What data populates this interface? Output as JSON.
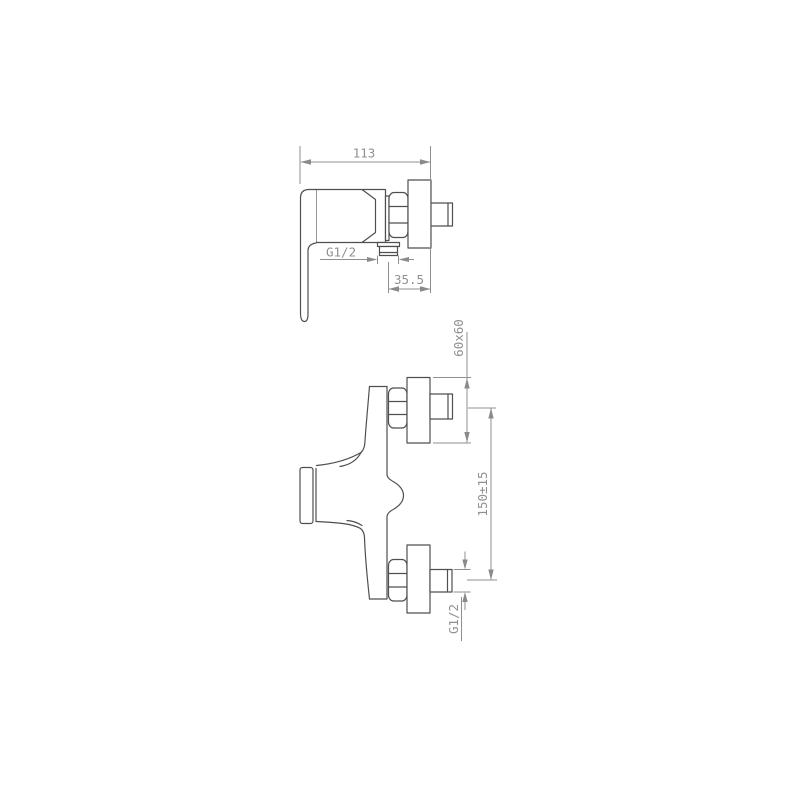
{
  "drawing": {
    "colors": {
      "background": "#ffffff",
      "object_line": "#4f4f4f",
      "dimension_line": "#8f8f8f",
      "text": "#909090"
    },
    "top_view": {
      "dims": {
        "overall_width": "113",
        "outlet_thread": "G1/2",
        "outlet_offset": "35.5"
      }
    },
    "front_view": {
      "dims": {
        "flange_size": "60x60",
        "inlet_spacing": "150±15",
        "inlet_thread": "G1/2"
      }
    }
  }
}
